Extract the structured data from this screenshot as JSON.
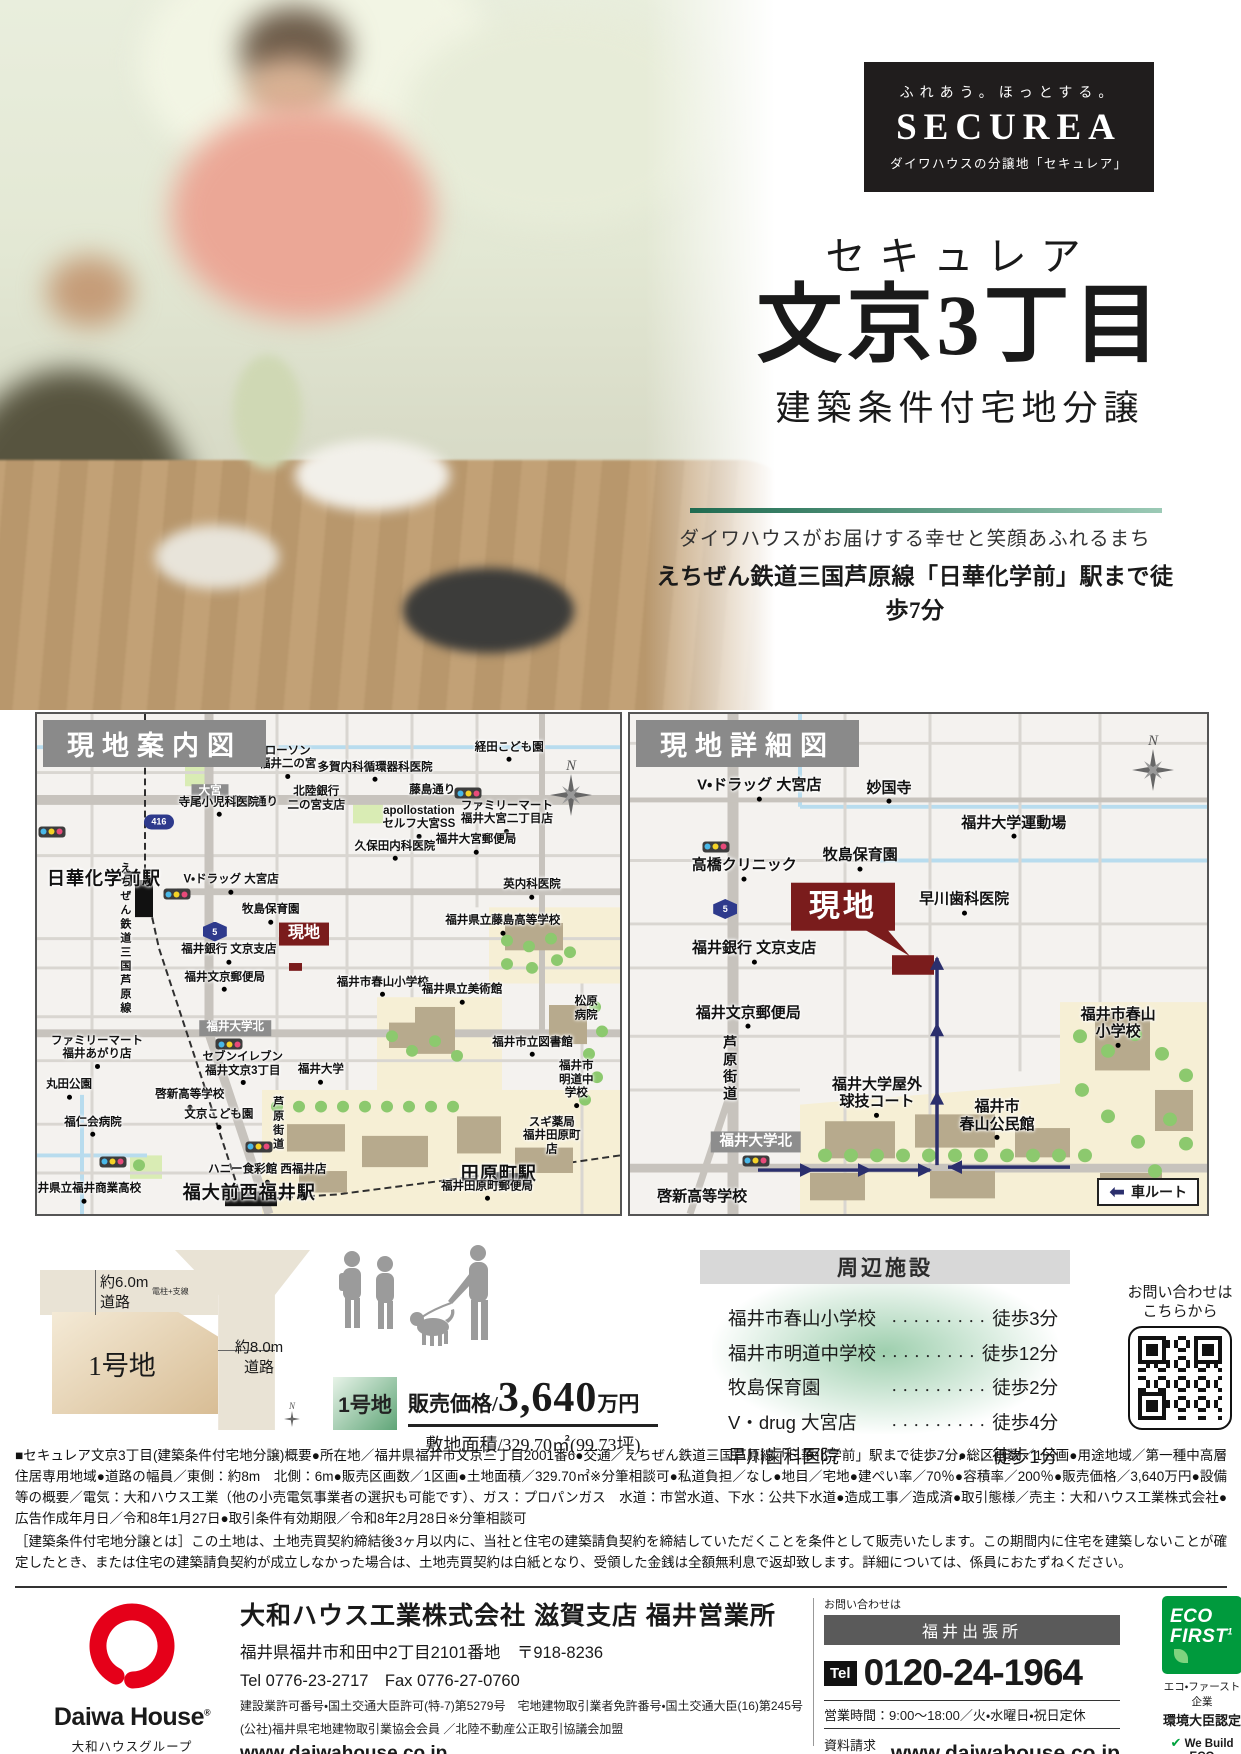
{
  "brand": {
    "tagline": "ふれあう。ほっとする。",
    "logo": "SECUREA",
    "subtitle": "ダイワハウスの分譲地「セキュレア」"
  },
  "title": {
    "kana": "セキュレア",
    "name": "文京3丁目",
    "condition": "建築条件付宅地分譲",
    "catch1": "ダイワハウスがお届けする幸せと笑顔あふれるまち",
    "catch2": "えちぜん鉄道三国芦原線「日華化学前」駅まで徒歩7分"
  },
  "maps": {
    "left": {
      "header": "現地案内図",
      "labels": [
        {
          "t": "ローソン\n福井二の宮",
          "x": 43,
          "y": 9.5,
          "d": 1
        },
        {
          "t": "多賀内科循環器科医院",
          "x": 58,
          "y": 11.5,
          "d": 1
        },
        {
          "t": "経田こども園",
          "x": 81,
          "y": 7.5,
          "d": 1
        },
        {
          "t": "大宮",
          "x": 29.7,
          "y": 15.5,
          "c": "sign"
        },
        {
          "t": "藤島通り",
          "x": 37.4,
          "y": 17.8
        },
        {
          "t": "北陸銀行\n二の宮支店",
          "x": 47.9,
          "y": 17
        },
        {
          "t": "藤島通り",
          "x": 67.8,
          "y": 15.3
        },
        {
          "t": "apollostation\nセルフ大宮SS",
          "x": 65.5,
          "y": 21.5,
          "d": 1
        },
        {
          "t": "ファミリーマート\n福井大宮二丁目店",
          "x": 80.6,
          "y": 20.5,
          "d": 1
        },
        {
          "t": "416",
          "x": 20.9,
          "y": 21.5,
          "c": "badge"
        },
        {
          "t": "寺尾小児科医院",
          "x": 31.2,
          "y": 18.5,
          "d": 1
        },
        {
          "t": "日華化学前駅",
          "x": 11.5,
          "y": 33,
          "c": "station"
        },
        {
          "t": "えちぜん鉄道三国芦原線",
          "x": 15,
          "y": 45,
          "c": "vert"
        },
        {
          "t": "V・ドラッグ 大宮店",
          "x": 33.3,
          "y": 34,
          "d": 1
        },
        {
          "t": "牧島保育園",
          "x": 40.1,
          "y": 40,
          "d": 1
        },
        {
          "t": "現地",
          "x": 45.8,
          "y": 44,
          "c": "site"
        },
        {
          "t": "福井銀行 文京支店",
          "x": 32.9,
          "y": 48,
          "d": 1
        },
        {
          "t": "福井文京郵便局",
          "x": 32.2,
          "y": 53.5,
          "d": 1
        },
        {
          "t": "久保田内科医院",
          "x": 61.4,
          "y": 27.3,
          "d": 1
        },
        {
          "t": "福井大宮郵便局",
          "x": 75.3,
          "y": 26,
          "d": 1
        },
        {
          "t": "英内科医院",
          "x": 84.9,
          "y": 35,
          "d": 1
        },
        {
          "t": "福井県立藤島高等学校",
          "x": 79.9,
          "y": 42.2,
          "d": 1
        },
        {
          "t": "福井市春山小学校",
          "x": 59.3,
          "y": 54.5,
          "d": 1
        },
        {
          "t": "福井県立美術館",
          "x": 72.9,
          "y": 56,
          "d": 1
        },
        {
          "t": "松原病院",
          "x": 94.2,
          "y": 59
        },
        {
          "t": "福井大学北",
          "x": 34,
          "y": 62.8,
          "c": "sign"
        },
        {
          "t": "ファミリーマート\n福井あがり店",
          "x": 10.3,
          "y": 67.5,
          "d": 1
        },
        {
          "t": "丸田公園",
          "x": 5.5,
          "y": 75,
          "d": 1
        },
        {
          "t": "セブンイレブン\n福井文京3丁目",
          "x": 35.3,
          "y": 70.8,
          "d": 1
        },
        {
          "t": "福井大学",
          "x": 48.7,
          "y": 72,
          "d": 1
        },
        {
          "t": "啓新高等学校",
          "x": 26.2,
          "y": 77,
          "d": 1
        },
        {
          "t": "福仁会病院",
          "x": 9.6,
          "y": 82.5,
          "d": 1
        },
        {
          "t": "文京こども園",
          "x": 31.2,
          "y": 81,
          "d": 1
        },
        {
          "t": "芦原街道",
          "x": 41.2,
          "y": 82,
          "c": "vert"
        },
        {
          "t": "ハニー食彩館 西福井店",
          "x": 39.5,
          "y": 92,
          "d": 1
        },
        {
          "t": "福井県立福井商業高校",
          "x": 8,
          "y": 95.8,
          "d": 1
        },
        {
          "t": "福大前西福井駅",
          "x": 36.4,
          "y": 95.8,
          "c": "station"
        },
        {
          "t": "田原町駅",
          "x": 79.2,
          "y": 92,
          "c": "station"
        },
        {
          "t": "福井田原町郵便局",
          "x": 77.2,
          "y": 95.3,
          "d": 1
        },
        {
          "t": "スギ薬局\n福井田原町店",
          "x": 88.3,
          "y": 84.5
        },
        {
          "t": "福井市明道中学校",
          "x": 92.5,
          "y": 74,
          "d": 1
        },
        {
          "t": "福井市立図書館",
          "x": 85,
          "y": 66.5,
          "d": 1
        },
        {
          "t": "5",
          "x": 30.5,
          "y": 43.5,
          "c": "badge hex"
        },
        {
          "t": "",
          "c": "tl",
          "x": 2.5,
          "y": 23.5
        },
        {
          "t": "",
          "c": "tl",
          "x": 74,
          "y": 15.8
        },
        {
          "t": "",
          "c": "tl",
          "x": 24,
          "y": 36
        },
        {
          "t": "",
          "c": "tl",
          "x": 33,
          "y": 66
        },
        {
          "t": "",
          "c": "tl",
          "x": 38,
          "y": 86.5
        },
        {
          "t": "",
          "c": "tl",
          "x": 13,
          "y": 89.5
        }
      ]
    },
    "right": {
      "header": "現地詳細図",
      "legend": "車ルート",
      "labels": [
        {
          "t": "V・ドラッグ 大宮店",
          "x": 22.4,
          "y": 15,
          "c": "lg",
          "d": 1
        },
        {
          "t": "妙国寺",
          "x": 44.9,
          "y": 15.5,
          "c": "lg",
          "d": 1
        },
        {
          "t": "高橋クリニック",
          "x": 19.8,
          "y": 31,
          "c": "lg",
          "d": 1
        },
        {
          "t": "牧島保育園",
          "x": 39.9,
          "y": 29,
          "c": "lg",
          "d": 1
        },
        {
          "t": "早川歯科医院",
          "x": 57.9,
          "y": 37.8,
          "c": "lg",
          "d": 1
        },
        {
          "t": "現地",
          "x": 36.9,
          "y": 38.5,
          "c": "site big"
        },
        {
          "t": "福井大学運動場",
          "x": 66.5,
          "y": 22.5,
          "c": "lg",
          "d": 1
        },
        {
          "t": "福井銀行 文京支店",
          "x": 21.5,
          "y": 47.6,
          "c": "lg",
          "d": 1
        },
        {
          "t": "福井文京郵便局",
          "x": 20.5,
          "y": 60.5,
          "c": "lg",
          "d": 1
        },
        {
          "t": "芦原街道",
          "x": 17.3,
          "y": 71,
          "c": "vert lg"
        },
        {
          "t": "福井大学屋外\n球技コート",
          "x": 42.8,
          "y": 76.5,
          "c": "lg",
          "d": 1
        },
        {
          "t": "福井市\n春山公民館",
          "x": 63.6,
          "y": 81,
          "c": "lg",
          "d": 1
        },
        {
          "t": "福井大学北",
          "x": 21.8,
          "y": 85.5,
          "c": "sign lg"
        },
        {
          "t": "啓新高等学校",
          "x": 12.5,
          "y": 96.5,
          "c": "lg"
        },
        {
          "t": "福井市春山小学校",
          "x": 84.6,
          "y": 62.5,
          "c": "lg",
          "d": 1
        },
        {
          "t": "5",
          "x": 16.5,
          "y": 39,
          "c": "badge hex"
        },
        {
          "t": "",
          "c": "tl",
          "x": 14.9,
          "y": 26.5
        },
        {
          "t": "",
          "c": "tl",
          "x": 21.8,
          "y": 89.3
        }
      ]
    }
  },
  "plot": {
    "lot": "1号地",
    "road_top": "約6.0m\n道路",
    "road_right": "約8.0m\n道路",
    "pole": "電柱+支線",
    "north": "N"
  },
  "price": {
    "lot": "1号地",
    "label": "販売価格/",
    "value": "3,640",
    "unit": "万円",
    "area": "敷地面積/329.70㎡(99.73坪)"
  },
  "facilities": {
    "header": "周辺施設",
    "leader": "・・・・・・・・・",
    "items": [
      {
        "name": "福井市春山小学校",
        "time": "徒歩3分"
      },
      {
        "name": "福井市明道中学校",
        "time": "徒歩12分"
      },
      {
        "name": "牧島保育園",
        "time": "徒歩2分"
      },
      {
        "name": "V・drug 大宮店",
        "time": "徒歩4分"
      },
      {
        "name": "早川歯科医院",
        "time": "徒歩1分"
      }
    ]
  },
  "qr": {
    "line1": "お問い合わせは",
    "line2": "こちらから"
  },
  "legal": {
    "overview": "■セキュレア文京3丁目(建築条件付宅地分譲)概要●所在地／福井県福井市文京三丁目2001番6●交通／えちぜん鉄道三国芦原線「日華化学前」駅まで徒歩7分●総区画数／1区画●用途地域／第一種中高層住居専用地域●道路の幅員／東側：約8m　北側：6m●販売区画数／1区画●土地面積／329.70㎡※分筆相談可●私道負担／なし●地目／宅地●建ぺい率／70％●容積率／200％●販売価格／3,640万円●設備等の概要／電気：大和ハウス工業（他の小売電気事業者の選択も可能です）、ガス：プロパンガス　水道：市営水道、下水：公共下水道●造成工事／造成済●取引態様／売主：大和ハウス工業株式会社●広告作成年月日／令和8年1月27日●取引条件有効期限／令和8年2月28日※分筆相談可",
    "conditions": "［建築条件付宅地分譲とは］この土地は、土地売買契約締結後3ヶ月以内に、当社と住宅の建築請負契約を締結していただくことを条件として販売いたします。この期間内に住宅を建築しないことが確定したとき、または住宅の建築請負契約が成立しなかった場合は、土地売買契約は白紙となり、受領した金銭は全額無利息で返却致します。詳細については、係員におたずねください。"
  },
  "footer": {
    "logo_name": "Daiwa House",
    "logo_reg": "®",
    "logo_group": "大和ハウスグループ",
    "company": "大和ハウス工業株式会社 滋賀支店 福井営業所",
    "address": "福井県福井市和田中2丁目2101番地　〒918-8236",
    "tel_fax": "Tel 0776-23-2717　Fax 0776-27-0760",
    "license1": "建設業許可番号・国土交通大臣許可(特-7)第5279号　宅地建物取引業者免許番号・国土交通大臣(16)第245号",
    "license2": "(公社)福井県宅地建物取引業協会会員 ／北陸不動産公正取引協議会加盟",
    "url": "www.daiwahouse.co.jp",
    "contact": {
      "ask": "お問い合わせは",
      "office": "福井出張所",
      "tel_badge": "Tel",
      "phone": "0120-24-1964",
      "hours": "営業時間：9:00～18:00／火・水曜日・祝日定休",
      "request_label": "資料請求は",
      "request_url": "www.daiwahouse.co.jp"
    },
    "eco": {
      "logo1": "ECO",
      "logo2": "FIRST",
      "line1": "エコ・ファースト企業",
      "line2": "環境大臣認定",
      "we_build": "We Build ECO",
      "group": "Daiwa House Group®"
    }
  }
}
